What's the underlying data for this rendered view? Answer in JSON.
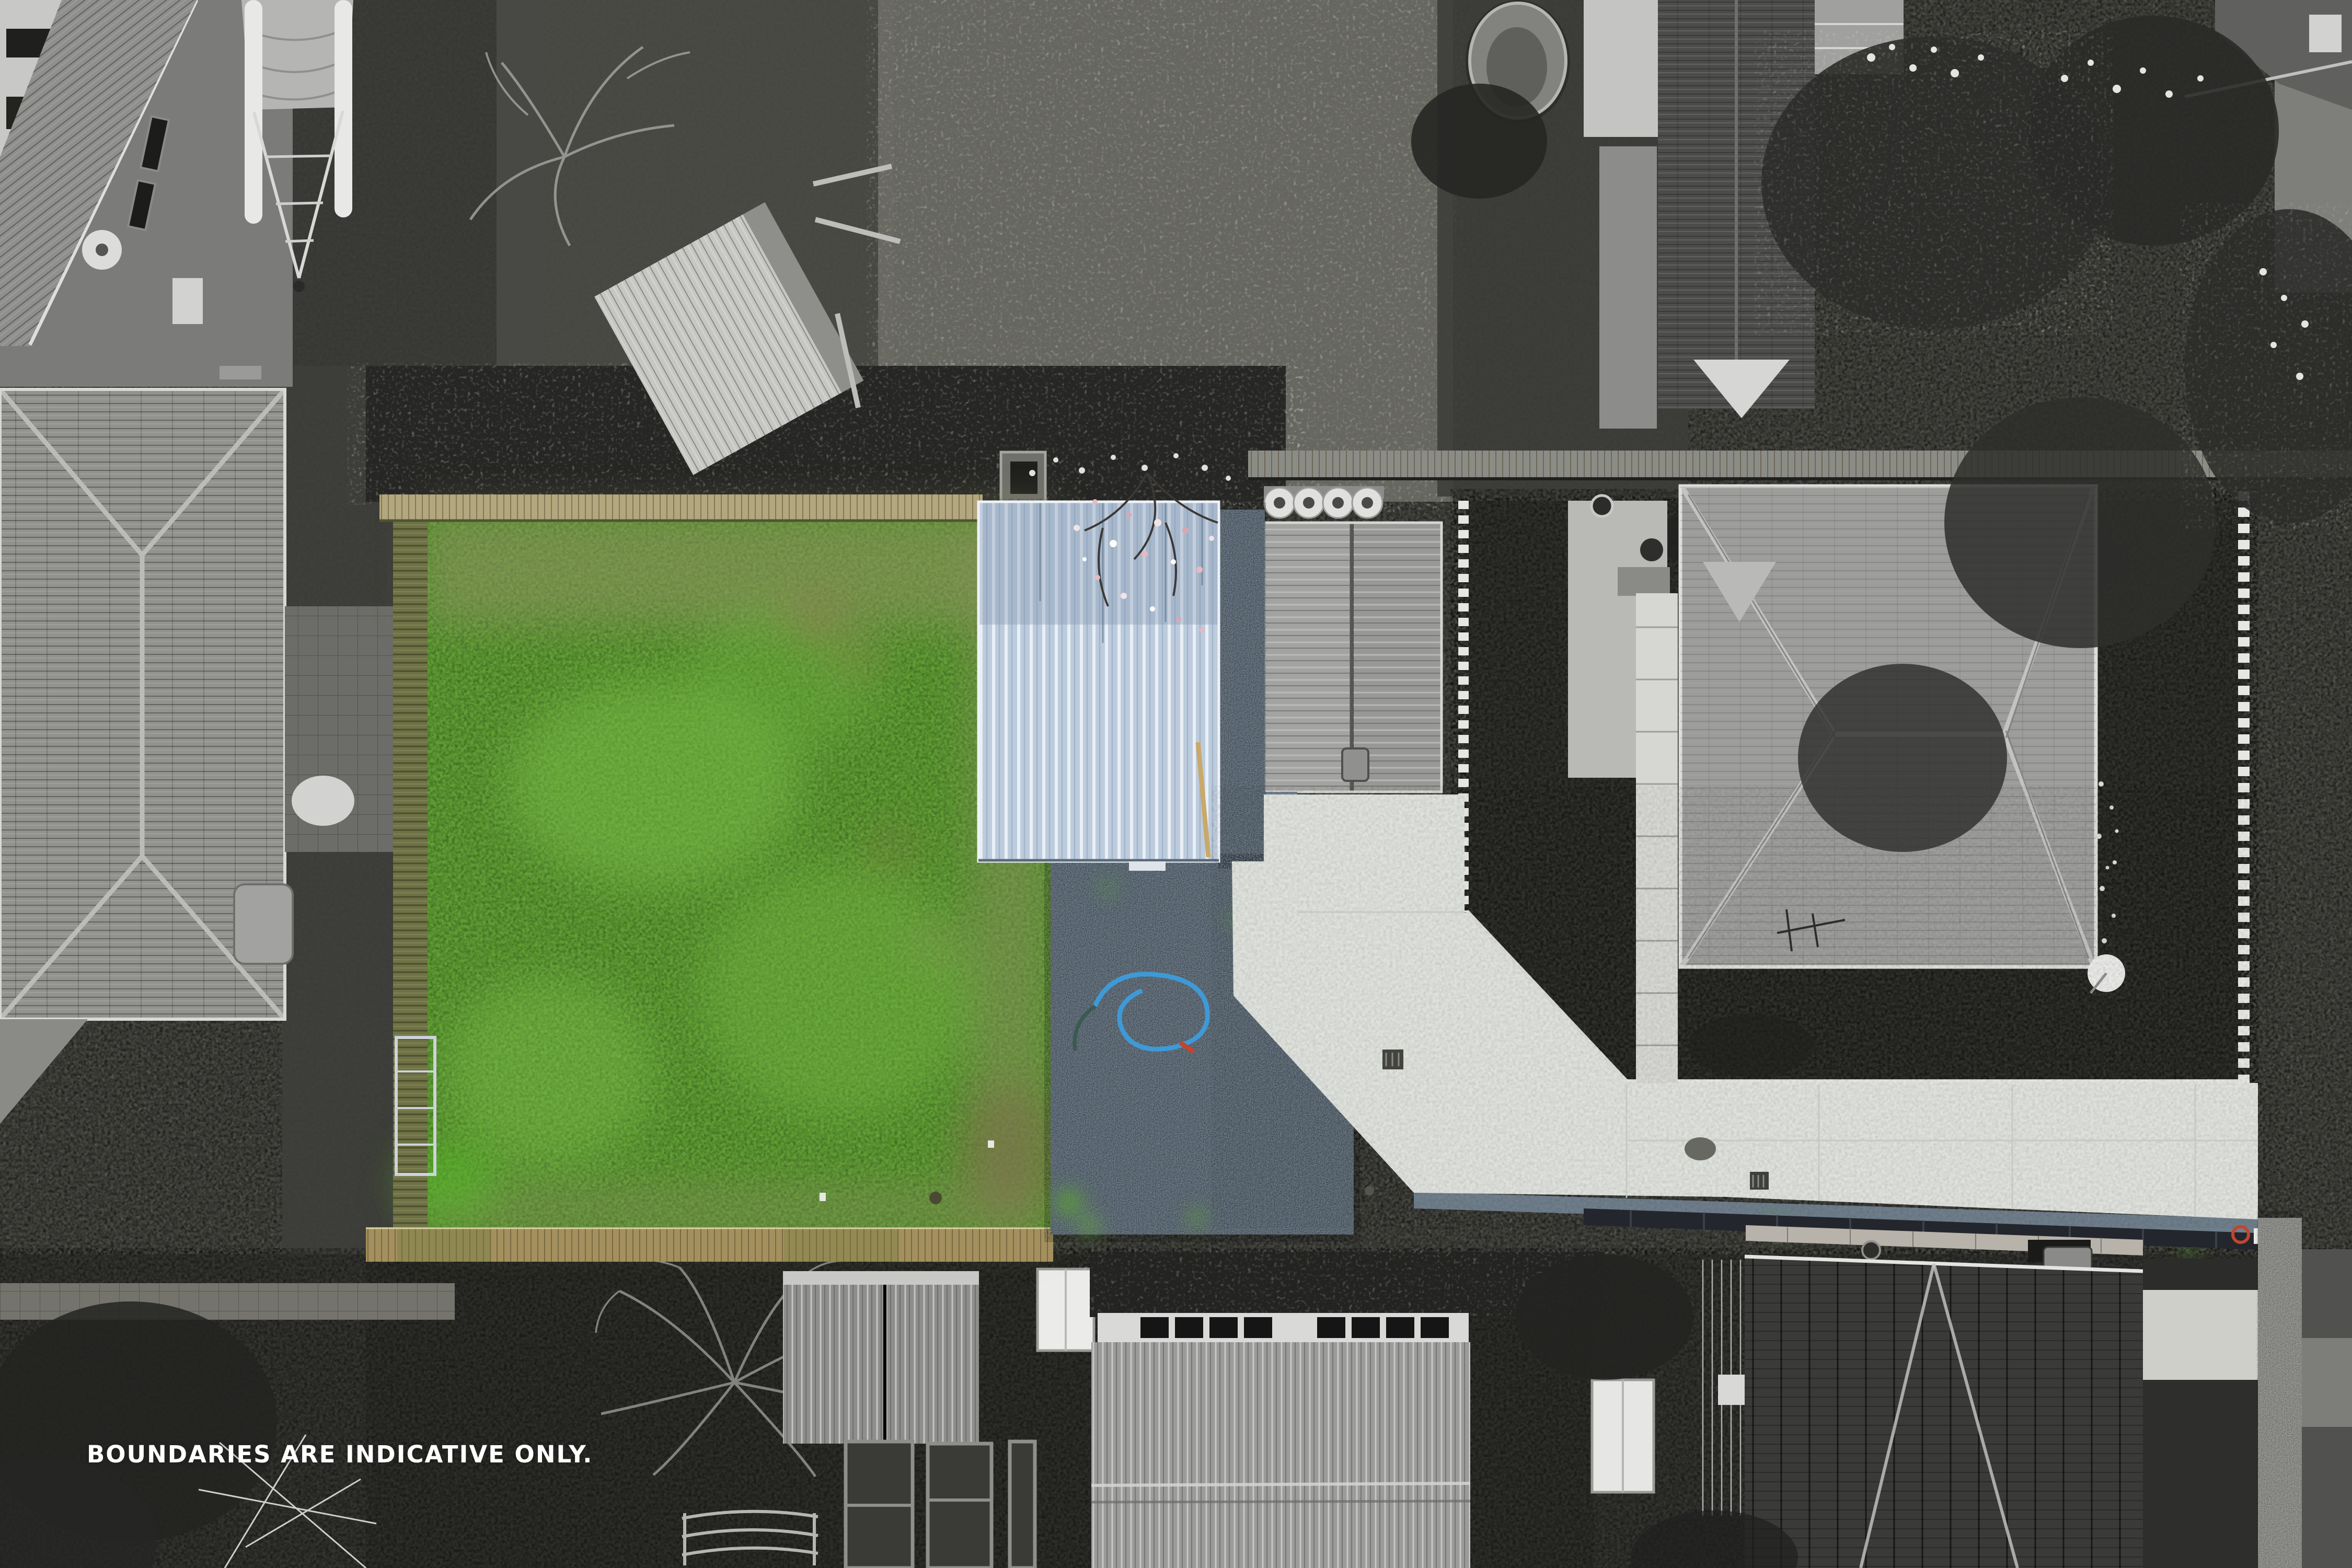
{
  "overlay": {
    "caption": "BOUNDARIES ARE INDICATIVE ONLY."
  },
  "palette": {
    "grass": "#5f9e33",
    "grass_light": "#7bbd47",
    "patch_olive": "#85905a",
    "patch_brown": "#8d7b52",
    "shed_roof_blue": "#bdccdd",
    "shed_roof_highlight": "#e9eff6",
    "gravel": "#6f7e8b",
    "concrete": "#dee1dc",
    "boardwalk": "#a3905e",
    "fence_olive": "#6f7246",
    "fence_rail": "#b3a77f",
    "hose_blue": "#3e9ad6",
    "blossom_pink": "#e7b9c3",
    "accent_red": "#c2452f",
    "caption_color": "#ffffff"
  }
}
